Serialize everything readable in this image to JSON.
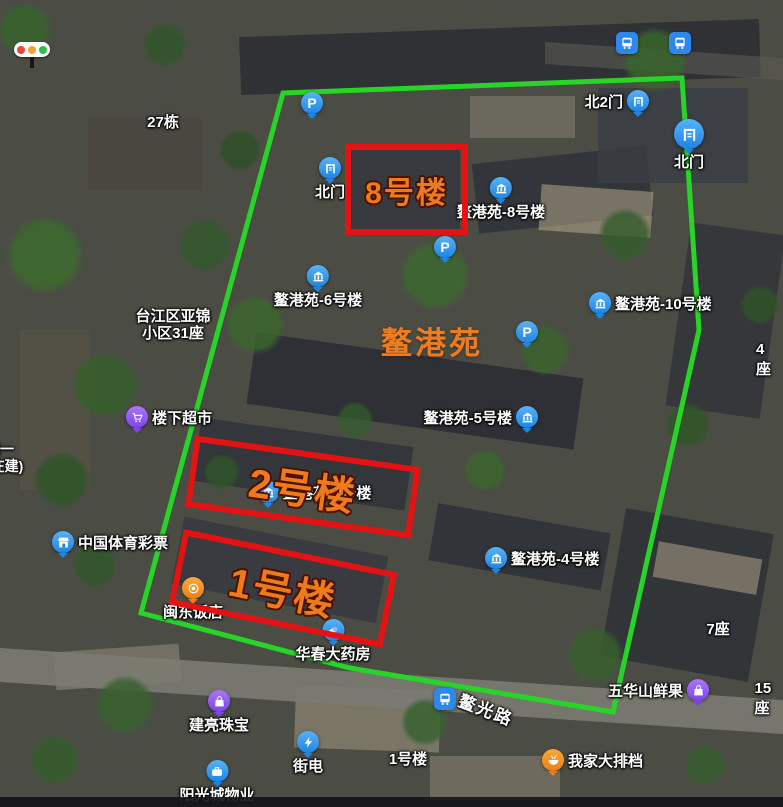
{
  "canvas": {
    "width": 783,
    "height": 807
  },
  "compound": {
    "name": "鳌港苑",
    "boundary_color": "#27d427",
    "box_color": "#e41313",
    "box_label_color": "#ef7a1a",
    "boxes": [
      {
        "label": "8号楼"
      },
      {
        "label": "2号楼"
      },
      {
        "label": "1号楼"
      }
    ]
  },
  "road": {
    "name": "鳌光路"
  },
  "parking": {
    "glyph": "P"
  },
  "traffic_light": {
    "icon": "traffic-light-icon",
    "colors": [
      "#e8473c",
      "#f0a33a",
      "#2fbf4e"
    ]
  },
  "pois": [
    {
      "label": "",
      "icon": "bus-stop-icon"
    },
    {
      "label": "",
      "icon": "bus-stop-icon"
    },
    {
      "label": "北2门",
      "icon": "gate-icon"
    },
    {
      "label": "北门",
      "icon": "gate-icon"
    },
    {
      "label": "",
      "icon": "parking-icon"
    },
    {
      "label": "北门",
      "icon": "gate-icon"
    },
    {
      "label": "鳌港苑-8号楼",
      "icon": "building-icon"
    },
    {
      "label": "",
      "icon": "parking-icon"
    },
    {
      "label": "鳌港苑-6号楼",
      "icon": "building-icon"
    },
    {
      "label": "鳌港苑-10号楼",
      "icon": "building-icon"
    },
    {
      "label": "",
      "icon": "parking-icon"
    },
    {
      "label": "鳌港苑-5号楼",
      "icon": "building-icon"
    },
    {
      "label": "鳌港苑-3号楼",
      "icon": "building-icon"
    },
    {
      "label": "鳌港苑-4号楼",
      "icon": "building-icon"
    },
    {
      "label": "楼下超市",
      "icon": "supermarket-cart-icon"
    },
    {
      "label": "中国体育彩票",
      "icon": "lottery-store-icon"
    },
    {
      "label": "闽东饭店",
      "icon": "restaurant-icon"
    },
    {
      "label": "华春大药房",
      "icon": "pharmacy-capsule-icon"
    },
    {
      "label": "",
      "icon": "bus-stop-icon"
    },
    {
      "label": "五华山鲜果",
      "icon": "fruit-shop-bag-icon"
    },
    {
      "label": "我家大排档",
      "icon": "food-stall-icon"
    },
    {
      "label": "街电",
      "icon": "power-bank-icon"
    },
    {
      "label": "建亮珠宝",
      "icon": "jewelry-bag-icon"
    },
    {
      "label": "阳光城物业",
      "icon": "property-office-icon"
    }
  ],
  "map_texts": [
    {
      "text": "27栋"
    },
    {
      "text": "台江区亚锦"
    },
    {
      "text": "小区31座"
    },
    {
      "text": "4座"
    },
    {
      "text": "7座"
    },
    {
      "text": "15座"
    },
    {
      "text": "1号楼"
    },
    {
      "text": "线一"
    },
    {
      "text": "(在建)"
    }
  ]
}
